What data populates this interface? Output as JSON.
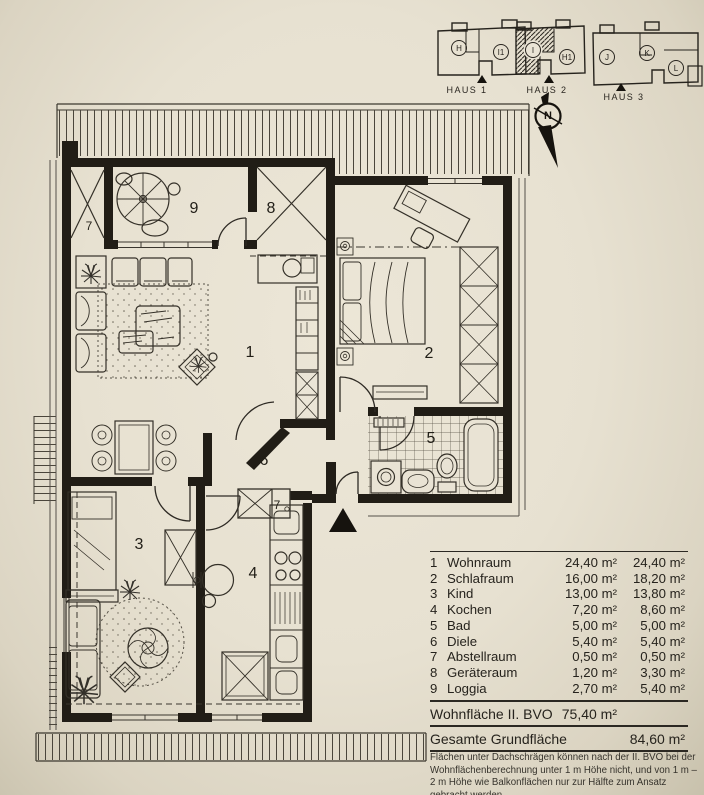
{
  "site_plan": {
    "houses": [
      {
        "label": "HAUS 1",
        "units": [
          "H",
          "I1"
        ]
      },
      {
        "label": "HAUS 2",
        "units": [
          "I",
          "H1"
        ]
      },
      {
        "label": "HAUS 3",
        "units": [
          "J",
          "K",
          "L"
        ]
      }
    ],
    "compass_label": "N"
  },
  "floor_plan": {
    "room_labels": [
      "1",
      "2",
      "3",
      "4",
      "5",
      "6",
      "7",
      "8",
      "9"
    ]
  },
  "area_table": {
    "rows": [
      {
        "num": "1",
        "name": "Wohnraum",
        "value1": "24,40 m²",
        "value2": "24,40 m²"
      },
      {
        "num": "2",
        "name": "Schlafraum",
        "value1": "16,00 m²",
        "value2": "18,20 m²"
      },
      {
        "num": "3",
        "name": "Kind",
        "value1": "13,00 m²",
        "value2": "13,80 m²"
      },
      {
        "num": "4",
        "name": "Kochen",
        "value1": "7,20 m²",
        "value2": "8,60 m²"
      },
      {
        "num": "5",
        "name": "Bad",
        "value1": "5,00 m²",
        "value2": "5,00 m²"
      },
      {
        "num": "6",
        "name": "Diele",
        "value1": "5,40 m²",
        "value2": "5,40 m²"
      },
      {
        "num": "7",
        "name": "Abstellraum",
        "value1": "0,50 m²",
        "value2": "0,50 m²"
      },
      {
        "num": "8",
        "name": "Geräteraum",
        "value1": "1,20 m²",
        "value2": "3,30 m²"
      },
      {
        "num": "9",
        "name": "Loggia",
        "value1": "2,70 m²",
        "value2": "5,40 m²"
      }
    ],
    "summary": [
      {
        "label": "Wohnfläche II. BVO",
        "value": "75,40 m²"
      },
      {
        "label": "Gesamte Grundfläche",
        "value": "84,60 m²"
      }
    ],
    "footnote": "Flächen unter Dachschrägen können nach der II. BVO bei der Wohnflächenberechnung unter 1 m Höhe nicht, und von 1 m – 2 m Höhe wie Balkonflächen nur zur Hälfte zum Ansatz gebracht werden."
  }
}
